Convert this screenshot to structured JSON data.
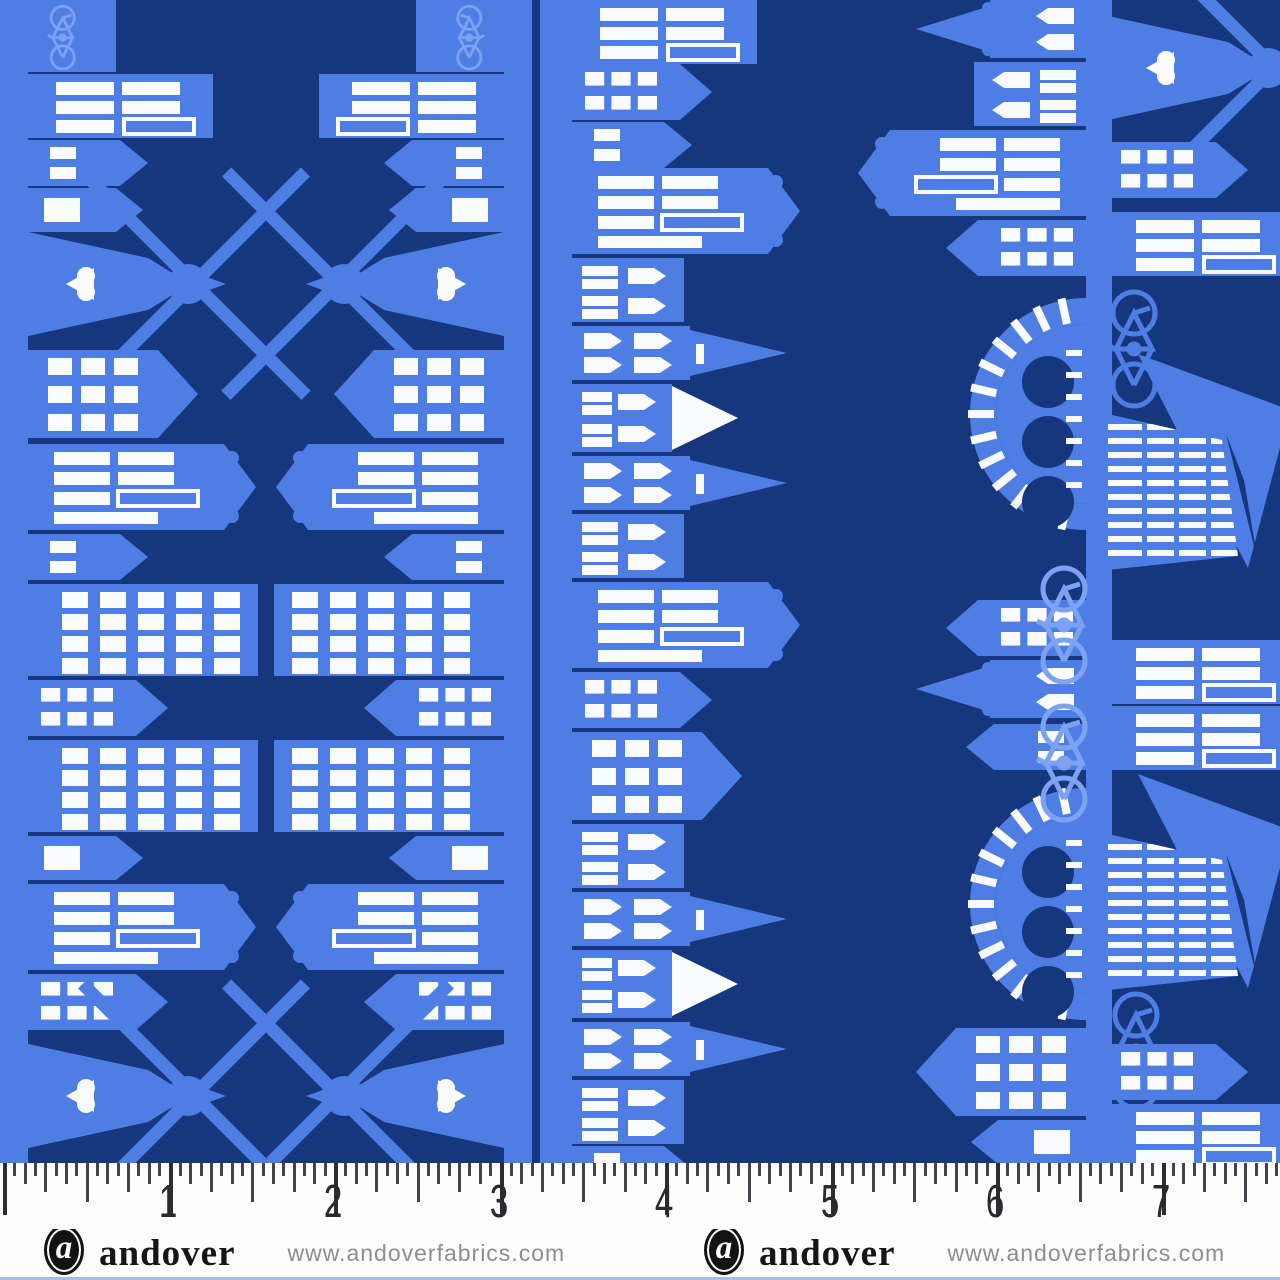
{
  "artwork": {
    "type": "fabric-swatch-photo",
    "description": "Blue border-stripe quilting fabric: rotated Dutch canal-house skylines with windmills, churches, bridges, ships and bicycles on a navy ground",
    "colors": {
      "navy": "#16367E",
      "blue": "#4E7EE4",
      "light_blue": "#7EA2F2",
      "white": "#FAFBFF"
    },
    "motifs": [
      "canal-house",
      "windmill",
      "church-spire",
      "arched-windows",
      "grand-gable-house",
      "canal-bridge",
      "bicycle",
      "sailing-ship",
      "heart-gable"
    ],
    "fabric_height_px": 1163,
    "strips": [
      {
        "name": "street-left-edge",
        "dir": 1,
        "base": 28,
        "band": [
          0,
          28
        ],
        "items": [
          [
            "bikeblock",
            0
          ],
          [
            "bars",
            74
          ],
          [
            "small",
            140
          ],
          [
            "door",
            188
          ],
          [
            "windmill",
            222
          ],
          [
            "gable",
            350
          ],
          [
            "grand",
            444
          ],
          [
            "small",
            534
          ],
          [
            "flat4",
            584
          ],
          [
            "smallgrid",
            680
          ],
          [
            "flat4",
            740
          ],
          [
            "door",
            836
          ],
          [
            "grand",
            884
          ],
          [
            "smallgrid",
            974
          ],
          [
            "windmill",
            1034
          ]
        ]
      },
      {
        "name": "street-2-left-facing",
        "dir": -1,
        "base": 504,
        "band": [
          504,
          28
        ],
        "items": [
          [
            "bikeblock",
            0
          ],
          [
            "bars",
            74
          ],
          [
            "small",
            140
          ],
          [
            "door",
            188
          ],
          [
            "windmill",
            222
          ],
          [
            "gable",
            350
          ],
          [
            "grand",
            444
          ],
          [
            "small",
            534
          ],
          [
            "flat4",
            584
          ],
          [
            "smallgrid",
            680
          ],
          [
            "flat4",
            740
          ],
          [
            "door",
            836
          ],
          [
            "grand",
            884
          ],
          [
            "smallgrid",
            974
          ],
          [
            "windmill",
            1034
          ]
        ]
      },
      {
        "name": "street-2-right-facing",
        "dir": 1,
        "base": 572,
        "band": [
          540,
          32
        ],
        "items": [
          [
            "bars",
            0
          ],
          [
            "smallgrid",
            64
          ],
          [
            "small",
            122
          ],
          [
            "grand",
            168
          ],
          [
            "arches",
            258
          ],
          [
            "church",
            326
          ],
          [
            "whiteroof",
            384
          ],
          [
            "church",
            456
          ],
          [
            "arches",
            514
          ],
          [
            "grand",
            582
          ],
          [
            "smallgrid",
            672
          ],
          [
            "gable",
            732
          ],
          [
            "arches",
            824
          ],
          [
            "church",
            892
          ],
          [
            "whiteroof",
            950
          ],
          [
            "church",
            1022
          ],
          [
            "arches",
            1080
          ],
          [
            "small",
            1146
          ]
        ]
      },
      {
        "name": "street-3-left-facing",
        "dir": -1,
        "base": 1086,
        "band": [
          1086,
          22
        ],
        "items": [
          [
            "churchtower",
            0
          ],
          [
            "arches",
            62
          ],
          [
            "grand",
            130
          ],
          [
            "smallgrid",
            220
          ],
          [
            "bridge",
            298
          ],
          [
            "smallgrid",
            600
          ],
          [
            "churchtower",
            660
          ],
          [
            "small",
            724
          ],
          [
            "bridge",
            788
          ],
          [
            "gable",
            1028
          ],
          [
            "door",
            1120
          ]
        ]
      },
      {
        "name": "street-3-right-facing",
        "dir": 1,
        "base": 1108,
        "band": [
          1108,
          4
        ],
        "items": [
          [
            "windmill",
            6
          ],
          [
            "smallgrid",
            142
          ],
          [
            "bars",
            212
          ],
          [
            "bikeV",
            286,
            -8,
            "bike-mid"
          ],
          [
            "ship",
            350
          ],
          [
            "bikeV",
            562,
            -78,
            "bike-light"
          ],
          [
            "bars",
            640
          ],
          [
            "bikeV",
            700,
            -78,
            "bike-light"
          ],
          [
            "bars",
            706
          ],
          [
            "ship",
            770
          ],
          [
            "bikeV",
            988,
            -6,
            "bike-mid"
          ],
          [
            "smallgrid",
            1044
          ],
          [
            "bars",
            1104
          ]
        ]
      }
    ]
  },
  "ruler": {
    "unit": "inch",
    "numbers": [
      "1",
      "2",
      "3",
      "4",
      "5",
      "6",
      "7"
    ],
    "inch_px": 165.5,
    "offset_px": 3
  },
  "footer": {
    "brand": "andover",
    "logo_letter": "a",
    "url": "www.andoverfabrics.com",
    "groups": 2
  }
}
